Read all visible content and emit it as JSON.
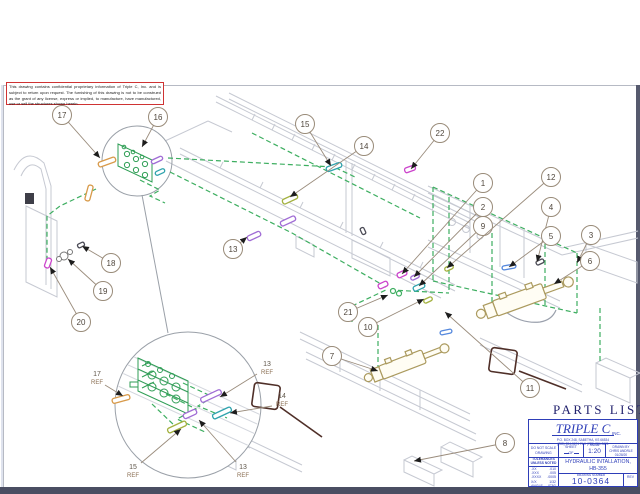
{
  "notice": {
    "text": "This drawing contains confidential proprietary information of Triple C, Inc. and is subject to return upon request.  The furnishing of this drawing is not to be construed as the grant of any license, express or implied, to manufacture, have manufactured, use or sell the structures shown herein."
  },
  "parts_list": {
    "label": "PARTS LIST"
  },
  "title_block": {
    "company": "TRIPLE C",
    "inc": "INC.",
    "address1": "P.O. BOX 248, SABETHA, KS 66534",
    "address2": "(785) 284-3674   FAX (785) 284-3621",
    "do_not_scale_1": "DO NOT SCALE",
    "do_not_scale_2": "DRAWING",
    "sheet_label": "SHEET",
    "of_label": "OF",
    "scale_label": "SCALE",
    "scale_value": "1:20",
    "drawn_by_label": "DRAWN BY",
    "drawn_by_name": "CHRIS ANDRLE",
    "drawn_date": "01/28/20",
    "tolerances_header": "TOLERANCES",
    "tolerances_sub": "UNLESS NOTED",
    "tolerances": [
      {
        "dim": ".XX",
        "tol": ".010"
      },
      {
        "dim": ".XXX",
        "tol": ".005"
      },
      {
        "dim": ".XXXX",
        "tol": ".0005"
      },
      {
        "dim": "X/X",
        "tol": "1/32"
      },
      {
        "dim": "ANGLE",
        "tol": "0°30'"
      }
    ],
    "title_line1": "HYDRAULIC INTALLATION,",
    "title_line2": "HB-355",
    "drawing_number_label": "DRAWING NUMBER",
    "drawing_number": "10-0364",
    "rev_label": "REV"
  },
  "balloons": {
    "b1": "1",
    "b2": "2",
    "b3": "3",
    "b4": "4",
    "b5": "5",
    "b6": "6",
    "b7": "7",
    "b8": "8",
    "b9": "9",
    "b10": "10",
    "b11": "11",
    "b12": "12",
    "b13": "13",
    "b14": "14",
    "b15": "15",
    "b16": "16",
    "b17": "17",
    "b18": "18",
    "b19": "19",
    "b20": "20",
    "b21": "21",
    "b22": "22"
  },
  "detail_refs": {
    "r17": {
      "num": "17",
      "suffix": "REF"
    },
    "r13a": {
      "num": "13",
      "suffix": "REF"
    },
    "r14": {
      "num": "14",
      "suffix": "REF"
    },
    "r15": {
      "num": "15",
      "suffix": "REF"
    },
    "r13b": {
      "num": "13",
      "suffix": "REF"
    }
  }
}
